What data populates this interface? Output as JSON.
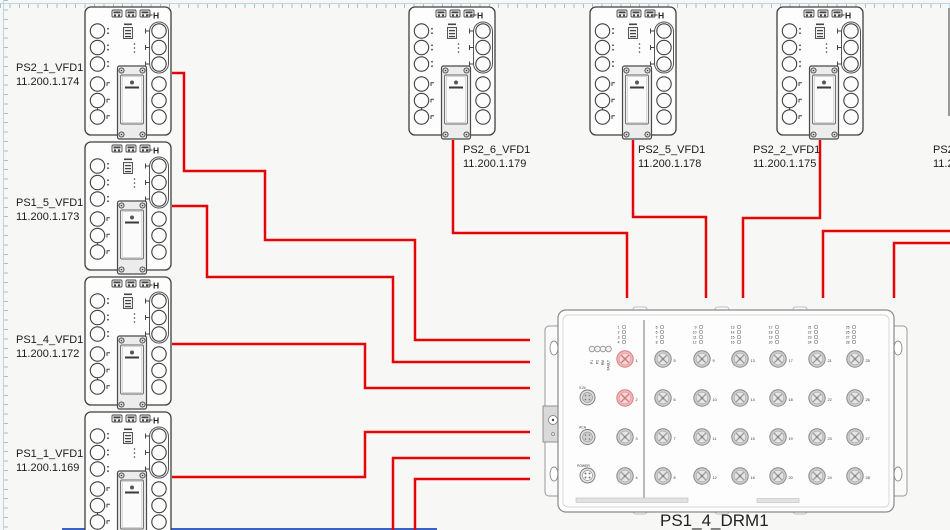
{
  "canvas": {
    "width": 950,
    "height": 530,
    "background": "#f7f7f6"
  },
  "colors": {
    "wire": "#e60404",
    "device_stroke": "#3f3f3f",
    "highlight_port": "#f2b6b6",
    "ruler": "#9fc2d6",
    "bottom_partial_device": "#3a62c4"
  },
  "vfd_glyph": "H",
  "devices": {
    "vfd_left": [
      {
        "name": "PS2_1_VFD1",
        "ip": "11.200.1.174"
      },
      {
        "name": "PS1_5_VFD1",
        "ip": "11.200.1.173"
      },
      {
        "name": "PS1_4_VFD1",
        "ip": "11.200.1.172"
      },
      {
        "name": "PS1_1_VFD1",
        "ip": "11.200.1.169"
      }
    ],
    "vfd_top": [
      {
        "name": "PS2_6_VFD1",
        "ip": "11.200.1.179"
      },
      {
        "name": "PS2_5_VFD1",
        "ip": "11.200.1.178"
      },
      {
        "name": "PS2_2_VFD1",
        "ip": "11.200.1.175"
      }
    ],
    "vfd_partial_right": {
      "name": "PS2_",
      "ip": "11.2"
    },
    "drm": {
      "name": "PS1_4_DRM1",
      "leds": [
        "P1",
        "P2",
        "RM",
        "FAULT"
      ],
      "aux_ports": [
        "V.24",
        "ACA",
        "POWER"
      ],
      "columns": [
        [
          1,
          2,
          3,
          4
        ],
        [
          5,
          6,
          7,
          8
        ],
        [
          9,
          10,
          11,
          12
        ],
        [
          13,
          14,
          15,
          16
        ],
        [
          17,
          18,
          19,
          20
        ],
        [
          21,
          22,
          23,
          24
        ],
        [
          25,
          26,
          27,
          28
        ]
      ],
      "highlighted_ports": [
        1,
        2
      ]
    }
  },
  "wires": [
    {
      "source": "PS2_1_VFD1",
      "to": "PS1_4_DRM1",
      "points": [
        [
          172,
          73
        ],
        [
          184,
          73
        ],
        [
          184,
          171
        ],
        [
          265,
          171
        ],
        [
          265,
          240
        ],
        [
          415,
          240
        ],
        [
          415,
          340
        ],
        [
          530,
          340
        ]
      ]
    },
    {
      "source": "PS1_5_VFD1",
      "to": "PS1_4_DRM1",
      "points": [
        [
          172,
          206
        ],
        [
          207,
          206
        ],
        [
          207,
          277
        ],
        [
          393,
          277
        ],
        [
          393,
          362
        ],
        [
          530,
          362
        ]
      ]
    },
    {
      "source": "PS1_4_VFD1",
      "to": "PS1_4_DRM1",
      "points": [
        [
          172,
          344
        ],
        [
          365,
          344
        ],
        [
          365,
          388
        ],
        [
          530,
          388
        ]
      ]
    },
    {
      "source": "PS1_1_VFD1",
      "to": "PS1_4_DRM1",
      "points": [
        [
          172,
          477
        ],
        [
          365,
          477
        ],
        [
          365,
          432
        ],
        [
          530,
          432
        ]
      ]
    },
    {
      "source": "off-screen-bottom",
      "to": "PS1_4_DRM1",
      "points": [
        [
          393,
          532
        ],
        [
          393,
          458
        ],
        [
          530,
          458
        ]
      ]
    },
    {
      "source": "off-screen-bottom",
      "to": "PS1_4_DRM1",
      "points": [
        [
          415,
          532
        ],
        [
          415,
          479
        ],
        [
          530,
          479
        ]
      ]
    },
    {
      "source": "PS2_6_VFD1",
      "to": "PS1_4_DRM1",
      "points": [
        [
          453,
          140
        ],
        [
          453,
          233
        ],
        [
          627,
          233
        ],
        [
          627,
          298
        ]
      ]
    },
    {
      "source": "PS2_5_VFD1",
      "to": "PS1_4_DRM1",
      "points": [
        [
          633,
          140
        ],
        [
          633,
          217
        ],
        [
          706,
          217
        ],
        [
          706,
          298
        ]
      ]
    },
    {
      "source": "PS2_2_VFD1",
      "to": "PS1_4_DRM1",
      "points": [
        [
          820,
          140
        ],
        [
          820,
          218
        ],
        [
          743,
          218
        ],
        [
          743,
          298
        ]
      ]
    },
    {
      "source": "off-screen-right",
      "to": "PS1_4_DRM1",
      "points": [
        [
          951,
          231
        ],
        [
          823,
          231
        ],
        [
          823,
          298
        ]
      ]
    },
    {
      "source": "off-screen-right",
      "to": "PS1_4_DRM1",
      "points": [
        [
          951,
          243
        ],
        [
          894,
          243
        ],
        [
          894,
          298
        ]
      ]
    }
  ]
}
